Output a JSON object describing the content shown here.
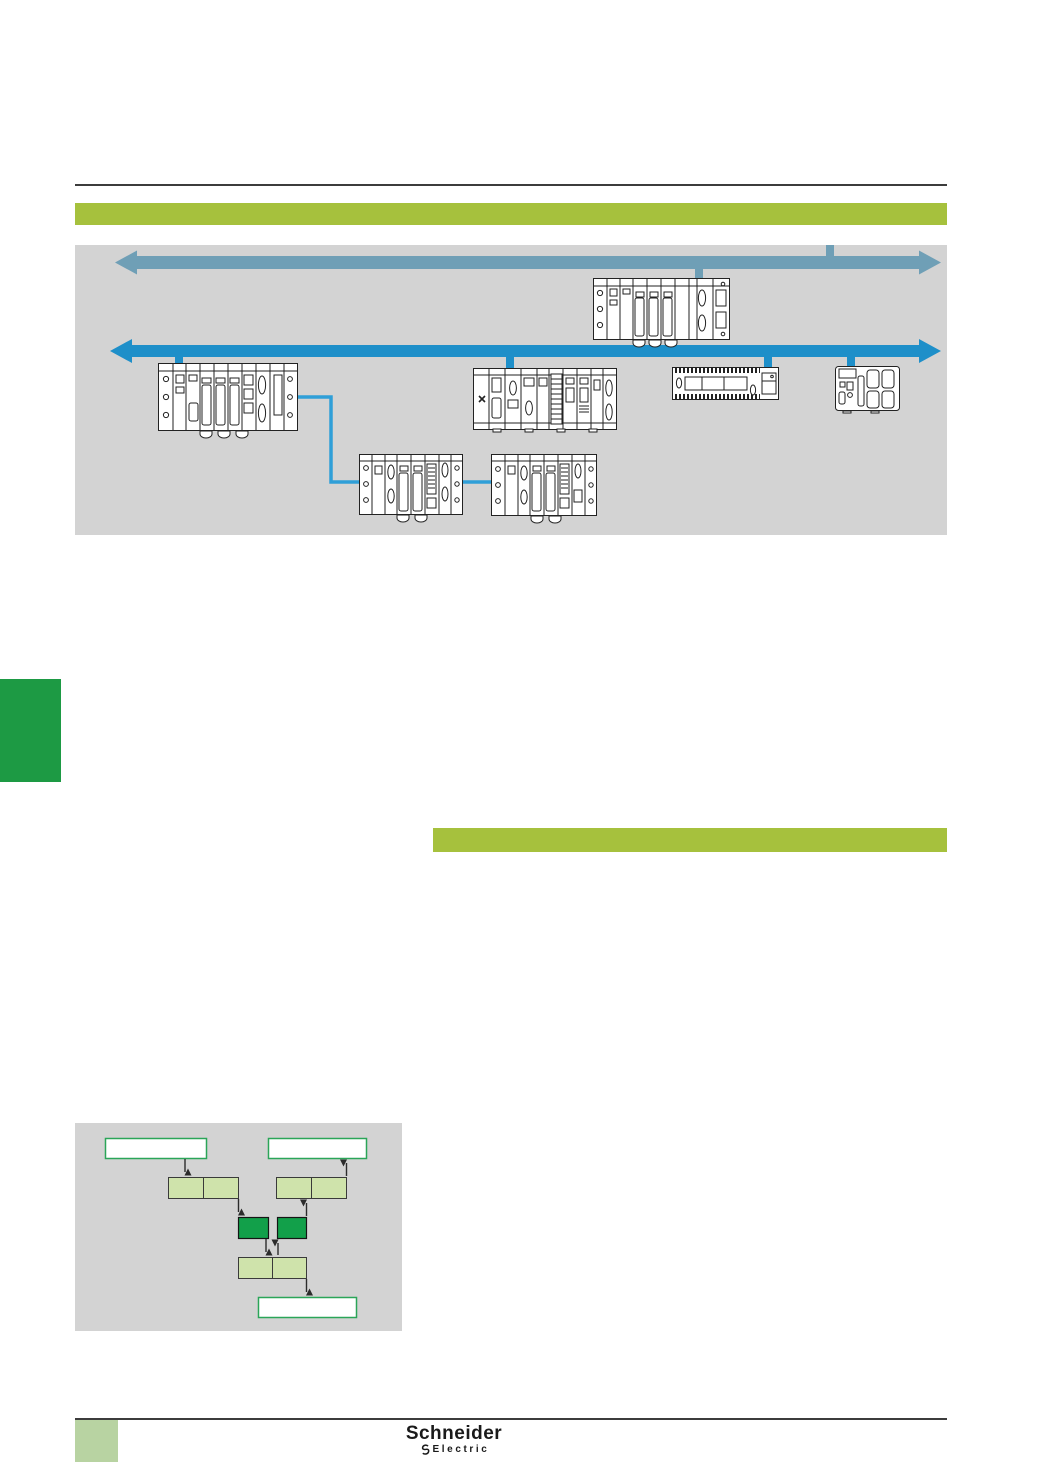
{
  "footer": {
    "brand_name": "Schneider",
    "brand_sub": "Electric"
  },
  "colors": {
    "page_bg": "#ffffff",
    "rule": "#3c3c3c",
    "banner_green": "#a6c13d",
    "panel_gray": "#d3d3d3",
    "bus_upper_blue": "#6f9fb6",
    "bus_lower_blue": "#1e8fc9",
    "device_link_blue": "#2f9fd8",
    "chapter_marker_green": "#1d9a44",
    "footer_tab_green": "#b8d3a2",
    "flow_light_green": "#cfe3ab",
    "flow_dark_green": "#12a04a",
    "flow_white_box_border": "#2ba558",
    "line_art": "#222222"
  },
  "network_diagram": {
    "buses": [
      {
        "name": "upper-backbone-bus",
        "style": "double-headed-arrow"
      },
      {
        "name": "lower-fieldbus",
        "style": "double-headed-arrow"
      }
    ],
    "devices": [
      {
        "name": "plc-rack-top"
      },
      {
        "name": "plc-rack-left"
      },
      {
        "name": "io-rack-center"
      },
      {
        "name": "flat-io-base"
      },
      {
        "name": "compact-controller"
      },
      {
        "name": "remote-io-rack-1"
      },
      {
        "name": "remote-io-rack-2"
      }
    ]
  },
  "flowchart": {
    "nodes": [
      {
        "name": "input-box-top-left",
        "type": "white"
      },
      {
        "name": "output-box-top-right",
        "type": "white"
      },
      {
        "name": "buffer-pair-left",
        "type": "light-green"
      },
      {
        "name": "buffer-pair-right",
        "type": "light-green"
      },
      {
        "name": "process-cell-left",
        "type": "dark-green"
      },
      {
        "name": "process-cell-right",
        "type": "dark-green"
      },
      {
        "name": "buffer-pair-bottom",
        "type": "light-green"
      },
      {
        "name": "result-box-bottom",
        "type": "white"
      }
    ]
  }
}
